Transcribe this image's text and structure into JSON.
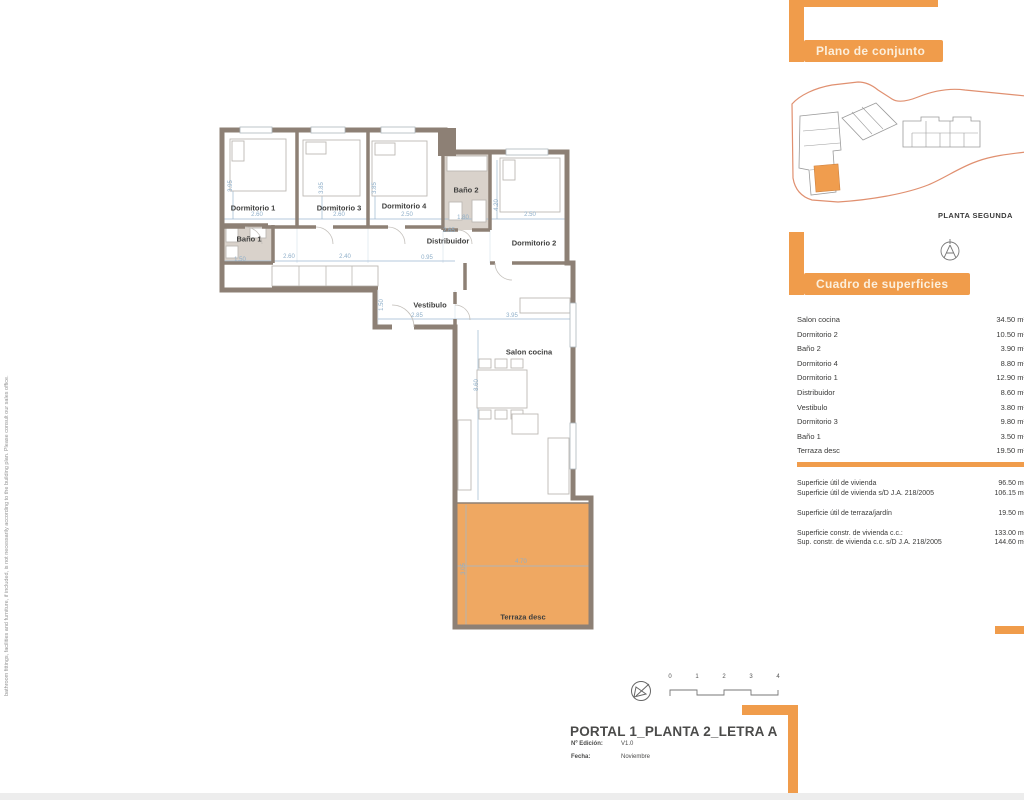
{
  "disclaimer": "bathroom fittings, facilities and furniture, if included, is not necessarily according to the building plan. Please consult our sales office.",
  "colors": {
    "accent": "#F09C4B",
    "terrace_fill": "#EFA862",
    "wall": "#8D8075",
    "dimension_text": "#8FAFC9",
    "site_boundary": "#E09070"
  },
  "site_panel": {
    "header": "Plano de conjunto",
    "caption": "PLANTA SEGUNDA"
  },
  "surfaces_panel": {
    "header": "Cuadro de superficies",
    "rows": [
      {
        "label": "Salon cocina",
        "value": "34.50 m²"
      },
      {
        "label": "Dormitorio 2",
        "value": "10.50 m²"
      },
      {
        "label": "Baño 2",
        "value": "3.90 m²"
      },
      {
        "label": "Dormitorio 4",
        "value": "8.80 m²"
      },
      {
        "label": "Dormitorio 1",
        "value": "12.90 m²"
      },
      {
        "label": "Distribuidor",
        "value": "8.60 m²"
      },
      {
        "label": "Vestibulo",
        "value": "3.80 m²"
      },
      {
        "label": "Dormitorio 3",
        "value": "9.80 m²"
      },
      {
        "label": "Baño 1",
        "value": "3.50 m²"
      },
      {
        "label": "Terraza desc",
        "value": "19.50 m²"
      }
    ],
    "summary": [
      {
        "label": "Superficie útil de vivienda",
        "value": "96.50 m²"
      },
      {
        "label": "Superficie útil de vivienda s/D J.A. 218/2005",
        "value": "106.15 m²"
      },
      {
        "label": "Superficie útil de terraza/jardín",
        "value": "19.50 m²"
      },
      {
        "label": "Superficie constr. de vivienda c.c.:",
        "value": "133.00 m²"
      },
      {
        "label": "Sup. constr. de vivienda c.c. s/D J.A. 218/2005",
        "value": "144.60 m²"
      }
    ]
  },
  "floor_plan": {
    "rooms": [
      {
        "t": "Dormitorio 1"
      },
      {
        "t": "Dormitorio 3"
      },
      {
        "t": "Dormitorio 4"
      },
      {
        "t": "Baño 2"
      },
      {
        "t": "Dormitorio 2"
      },
      {
        "t": "Baño 1"
      },
      {
        "t": "Distribuidor"
      },
      {
        "t": "Vestibulo"
      },
      {
        "t": "Salon cocina"
      },
      {
        "t": "Terraza desc"
      }
    ],
    "dims": [
      {
        "t": "3.95"
      },
      {
        "t": "2.60"
      },
      {
        "t": "3.85"
      },
      {
        "t": "2.60"
      },
      {
        "t": "3.85"
      },
      {
        "t": "2.50"
      },
      {
        "t": "1.80"
      },
      {
        "t": "4.20"
      },
      {
        "t": "2.50"
      },
      {
        "t": "2.65"
      },
      {
        "t": "2.60"
      },
      {
        "t": "2.40"
      },
      {
        "t": "0.95"
      },
      {
        "t": "1.50"
      },
      {
        "t": "1.50"
      },
      {
        "t": "2.85"
      },
      {
        "t": "3.95"
      },
      {
        "t": "8.60"
      },
      {
        "t": "4.70"
      },
      {
        "t": "3.05"
      }
    ]
  },
  "title_block": {
    "title": "PORTAL 1_PLANTA 2_LETRA A",
    "edition_label": "Nº Edición:",
    "edition_value": "V1.0",
    "date_label": "Fecha:",
    "date_value": "Noviembre",
    "scale_ticks": [
      "0",
      "1",
      "2",
      "3",
      "4"
    ]
  }
}
